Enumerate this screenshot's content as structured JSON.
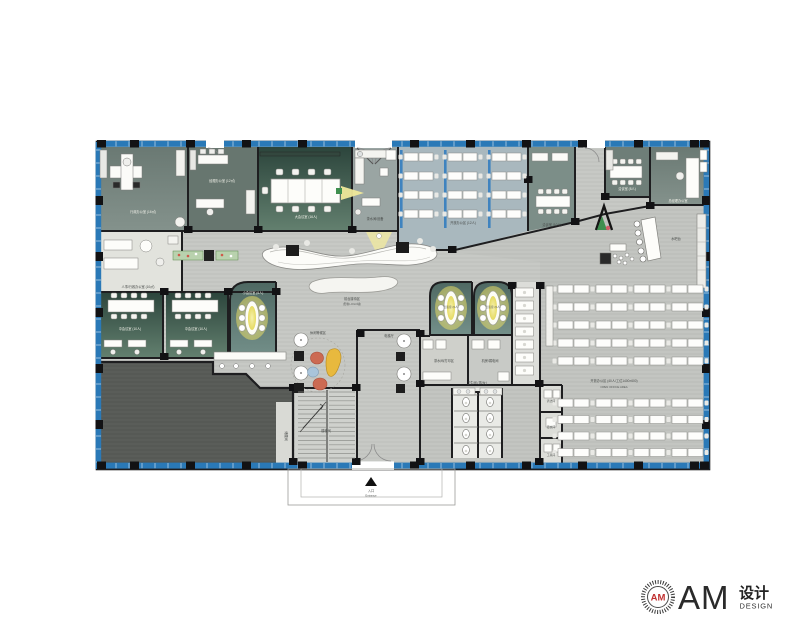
{
  "page": {
    "background": "#ffffff"
  },
  "colors": {
    "curtain_blue": "#2a79b7",
    "wall_dark": "#1e1e20",
    "floor_corridor": "#c7c9c5",
    "floor_open_right": "#c2c5c0",
    "room_slate": "#75837d",
    "room_slate_dark": "#67766f",
    "conference_dark": "#2c453c",
    "conference_light": "#63806f",
    "open_top_blue": "#a9b8be",
    "teal_room": "#5b736d",
    "dark_zone": "#5a5d59",
    "glow_yellow": "#efe9a0",
    "pouf_red": "#cc6a52",
    "pouf_blue": "#a9c4da",
    "sculpt_yellow": "#e8b93e",
    "planter_green": "#b9d2ae",
    "logo_red": "#c03030"
  },
  "plan": {
    "labels": {
      "exec_office": "行政办公室 (16㎡)",
      "office_b": "经理办公室 (12㎡)",
      "conference": "大会议室 (16人)",
      "pantry_top": "茶水间/设备",
      "open_top": "开放办公区 (12人)",
      "meet_f": "洽谈室 (10人)",
      "meet_right": "洽谈室 (8人)",
      "corner_office": "总经理办公室",
      "bar": "水吧台",
      "reception_1": "前台接待区",
      "reception_2": "(形象LOGO墙)",
      "office_h1": "人事/行政办公室 (10㎡)",
      "meet_1": "中会议室 (10人)",
      "meet_2": "中会议室 (10人)",
      "round_room": "小会议室 (6人)",
      "glow_a": "洽谈室 (6人)",
      "glow_b": "洽谈室 (6人)",
      "pantry_mid": "茶水间/打印区",
      "server": "机房/弱电间",
      "lounge": "休闲等候区",
      "stairs": "楼梯间",
      "storage": "储藏间",
      "restroom": "卫生间 (男/女)",
      "clean_1": "清洁间",
      "clean_2": "更衣间",
      "clean_3": "工具间",
      "open_main_1": "开放办公区 (40人/工位1400×600)",
      "open_main_2": "OPEN OFFICE AREA",
      "elevator": "电梯厅",
      "entrance_cn": "入口",
      "entrance_en": "Entrance"
    }
  },
  "logo": {
    "badge_text": "AM",
    "brand_initials": "AM",
    "brand_cn": "设计",
    "brand_en": "DESIGN"
  }
}
